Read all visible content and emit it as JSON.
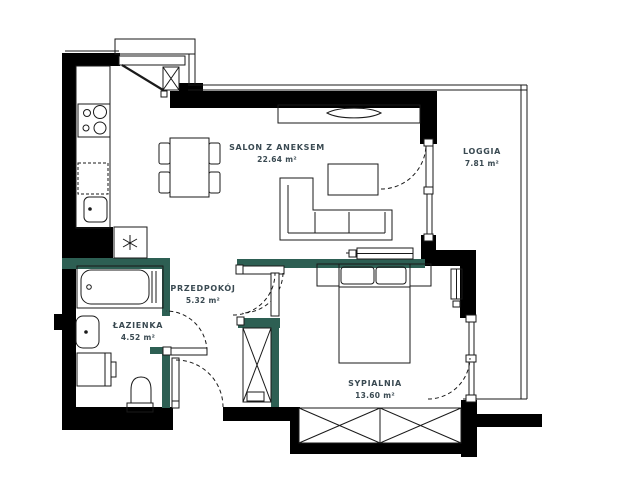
{
  "plan": {
    "rooms": [
      {
        "id": "salon",
        "label": "SALON Z ANEKSEM",
        "area": "22.64 m²"
      },
      {
        "id": "loggia",
        "label": "LOGGIA",
        "area": "7.81 m²"
      },
      {
        "id": "przedpokoj",
        "label": "PRZEDPOKÓJ",
        "area": "5.32 m²"
      },
      {
        "id": "lazienka",
        "label": "ŁAZIENKA",
        "area": "4.52 m²"
      },
      {
        "id": "sypialnia",
        "label": "SYPIALNIA",
        "area": "13.60 m²"
      }
    ],
    "colors": {
      "wall": "#000000",
      "partition_wall": "#2d5f53",
      "line": "#1a1a1a",
      "label_text": "#3a4a52",
      "background": "#ffffff"
    },
    "fixtures": [
      "entrance-door",
      "vent-shaft",
      "stove",
      "kitchen-sink",
      "dishwasher",
      "dining-table",
      "chair",
      "tv-cabinet",
      "sofa",
      "coffee-table",
      "radiator",
      "bathtub",
      "washbasin",
      "washing-machine",
      "toilet",
      "wardrobe",
      "double-bed",
      "nightstand",
      "pillow",
      "balcony-door",
      "window",
      "loggia"
    ]
  }
}
